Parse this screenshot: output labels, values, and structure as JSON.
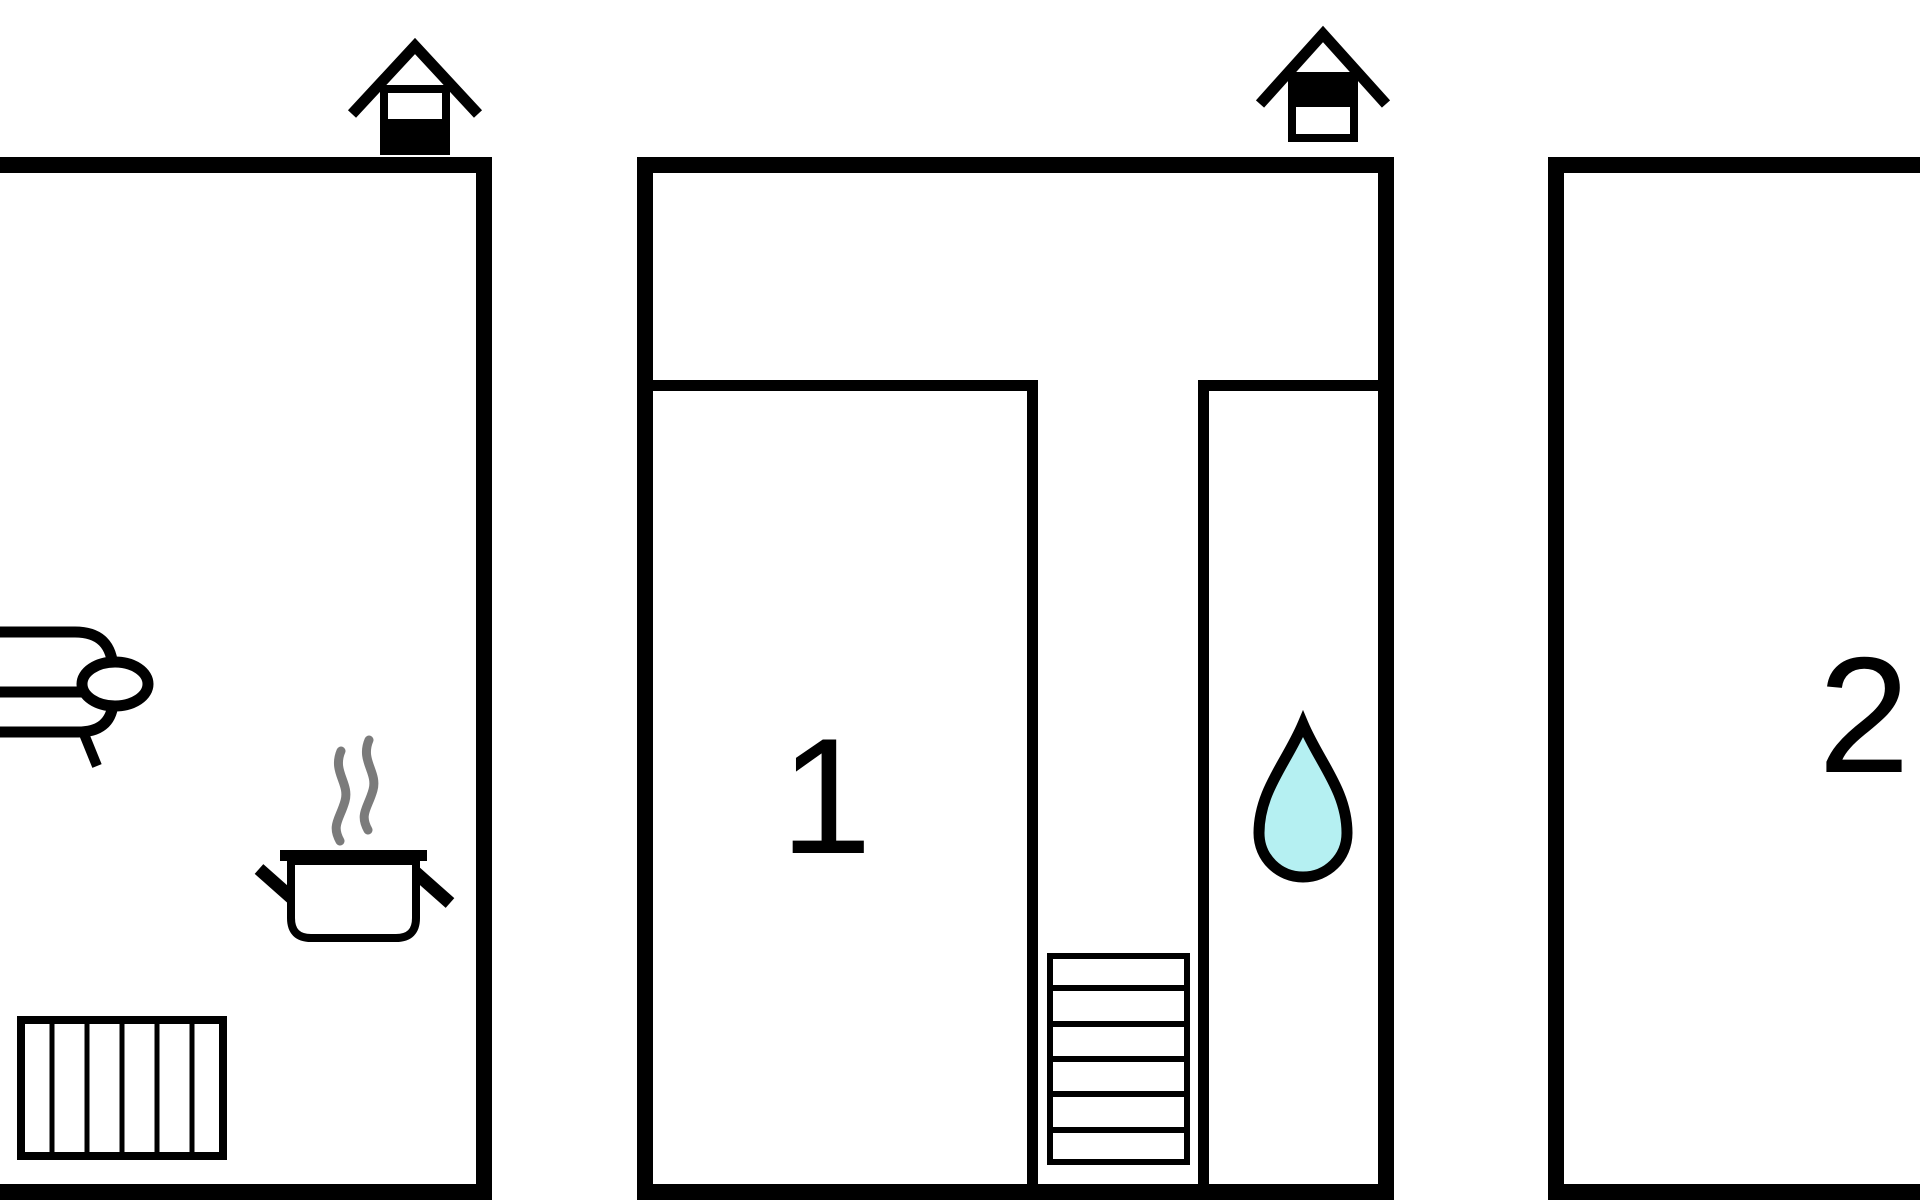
{
  "page": {
    "background": "#ffffff"
  },
  "plan": {
    "type": "floor-plan",
    "rooms": [
      {
        "label": "1"
      },
      {
        "label": "2"
      }
    ],
    "level_markers": [
      {
        "icon": "house-level-icon",
        "filled_half": "bottom"
      },
      {
        "icon": "house-level-icon",
        "filled_half": "top"
      }
    ],
    "icons": [
      "sofa-icon",
      "steam-icon",
      "cooking-pot-icon",
      "radiator-icon",
      "stairs-icon",
      "water-drop-icon",
      "house-level-icon"
    ],
    "colors": {
      "wall": "#000000",
      "steam": "#7b7b7b",
      "water_drop_fill": "#b5f0f2",
      "water_drop_stroke": "#000000",
      "label": "#000000"
    }
  }
}
